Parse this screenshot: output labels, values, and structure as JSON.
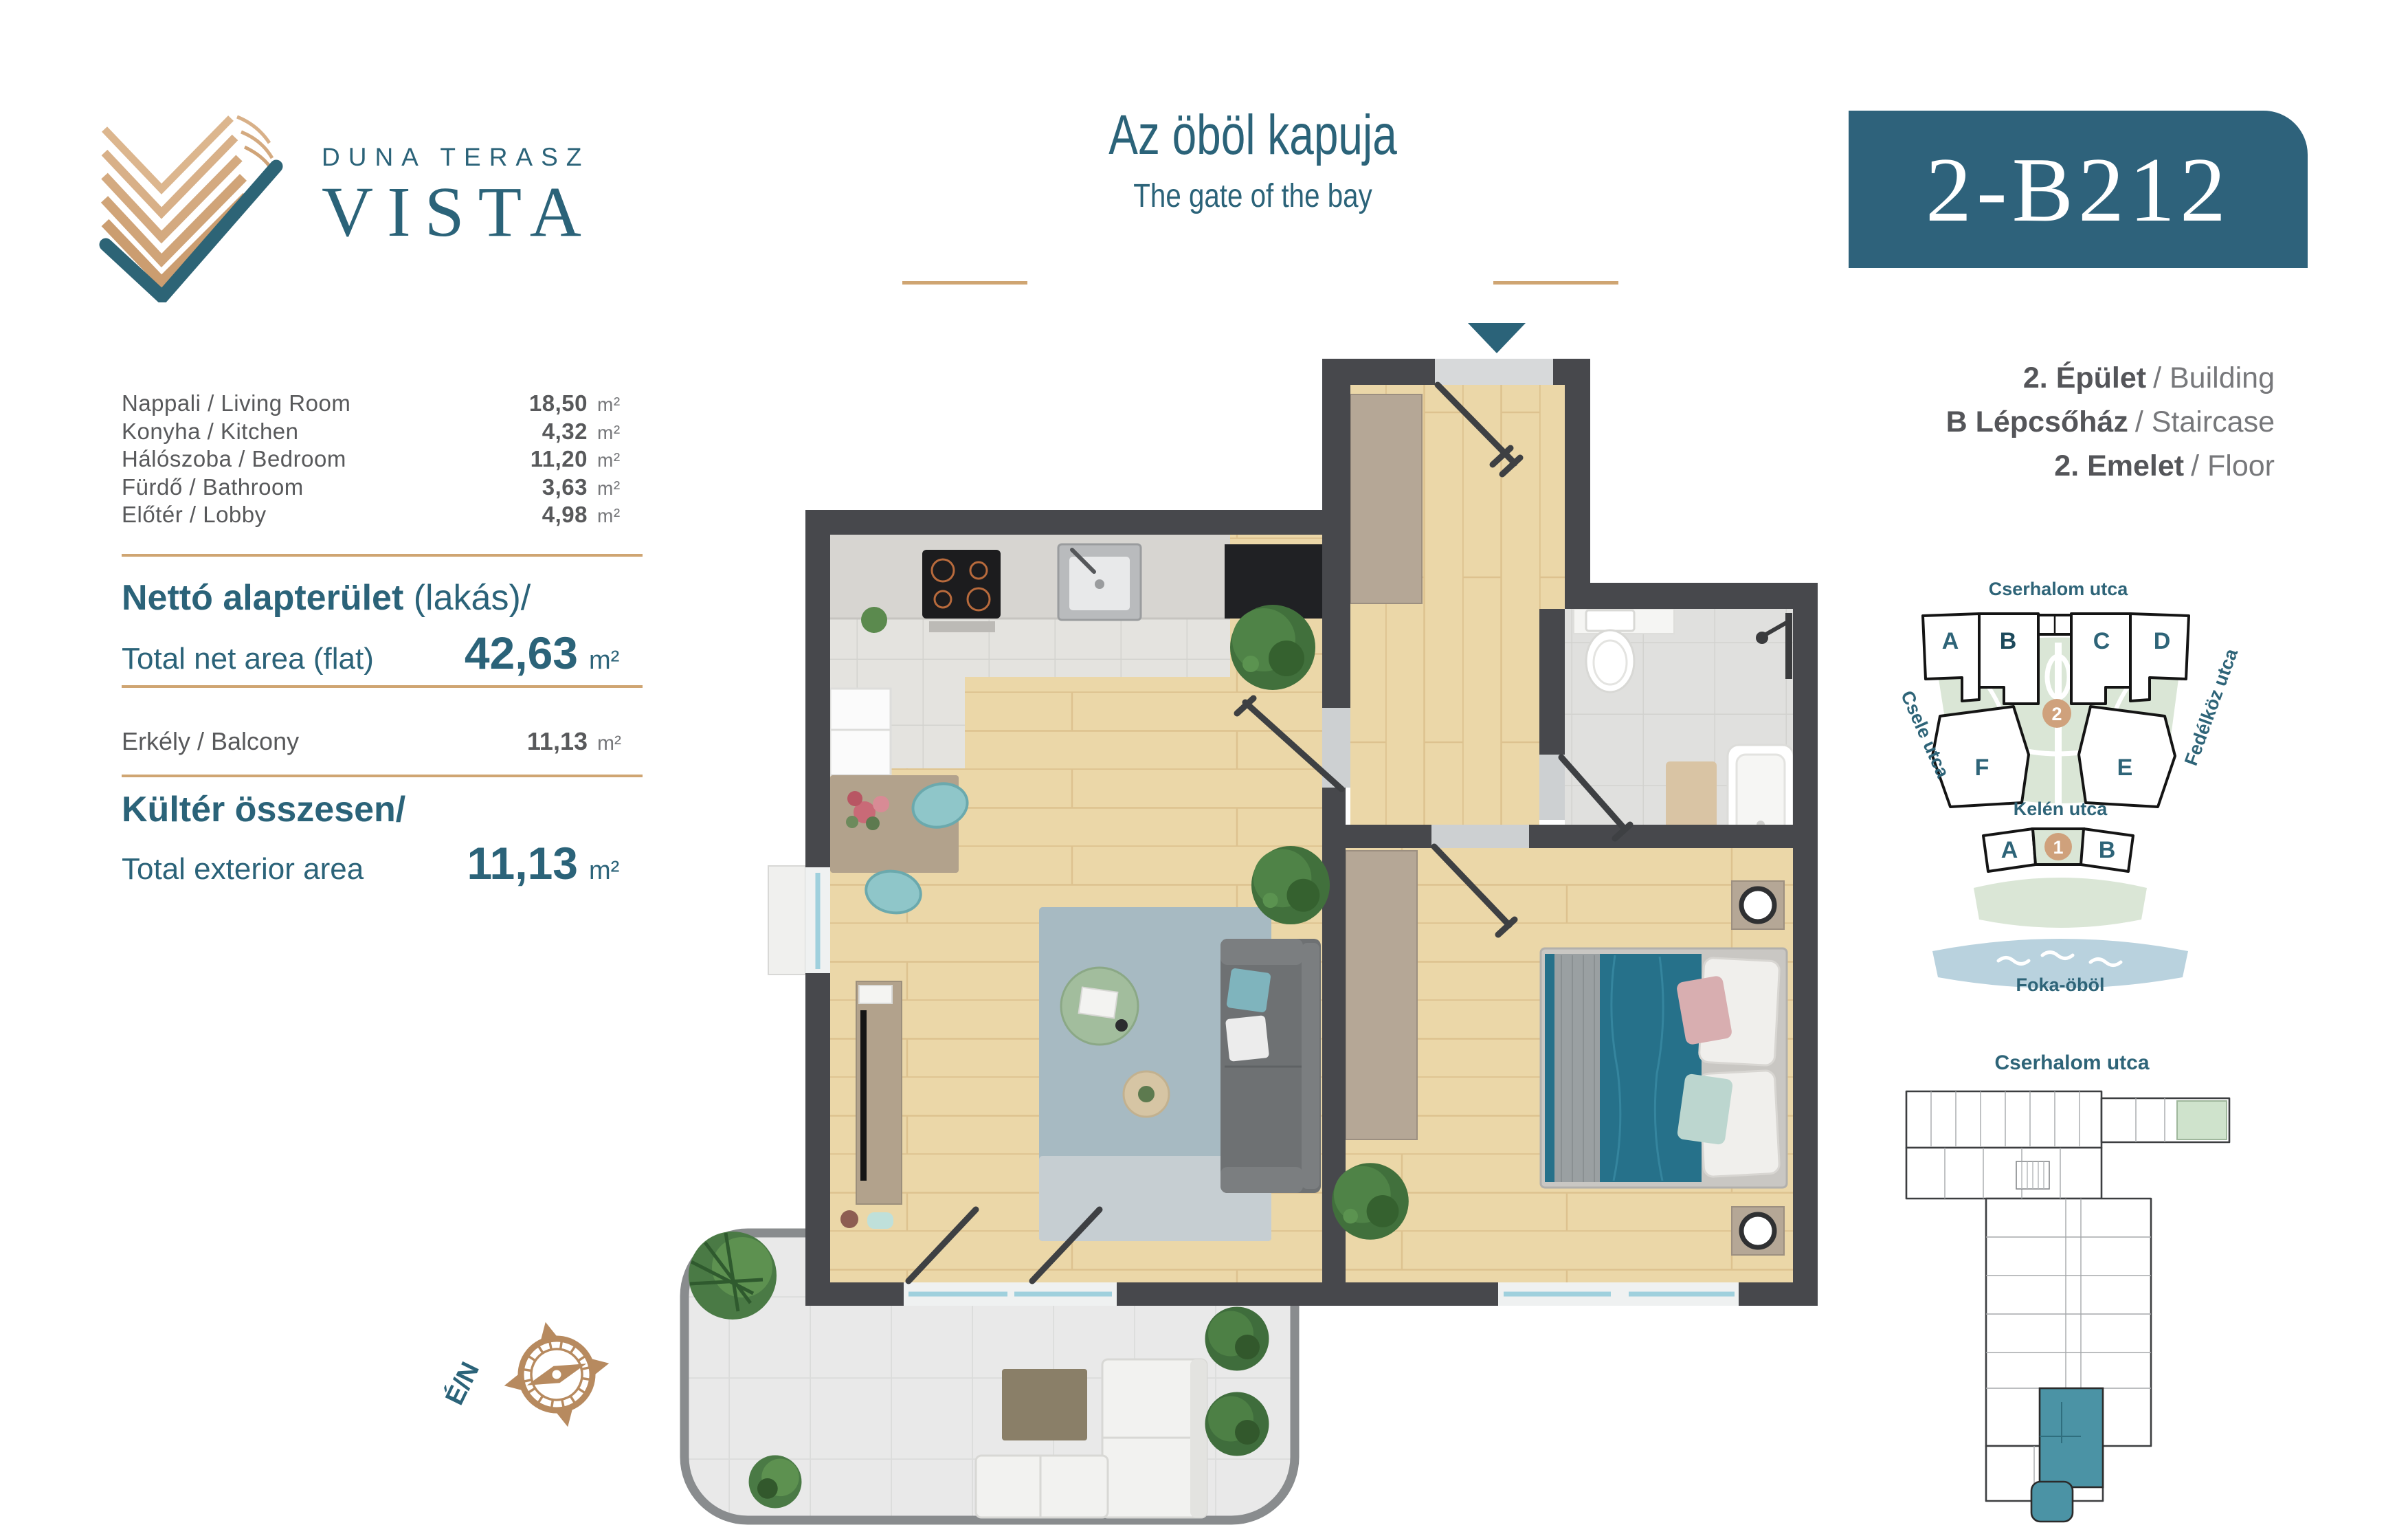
{
  "logo": {
    "tagline": "DUNA TERASZ",
    "name": "VISTA"
  },
  "header": {
    "title_hu": "Az öböl kapuja",
    "title_en": "The gate of the bay",
    "unit_code": "2-B212"
  },
  "areas": {
    "rooms": [
      {
        "label": "Nappali / Living Room",
        "value": "18,50",
        "unit": "m²"
      },
      {
        "label": "Konyha / Kitchen",
        "value": "4,32",
        "unit": "m²"
      },
      {
        "label": "Hálószoba / Bedroom",
        "value": "11,20",
        "unit": "m²"
      },
      {
        "label": "Fürdő / Bathroom",
        "value": "3,63",
        "unit": "m²"
      },
      {
        "label": "Előtér / Lobby",
        "value": "4,98",
        "unit": "m²"
      }
    ],
    "net": {
      "title_bold": "Nettó alapterület",
      "title_light": " (lakás)/",
      "label_en": "Total net area (flat)",
      "value": "42,63",
      "unit": "m²"
    },
    "balcony": {
      "label": "Erkély / Balcony",
      "value": "11,13",
      "unit": "m²"
    },
    "exterior": {
      "title": "Kültér összesen/",
      "label_en": "Total exterior area",
      "value": "11,13",
      "unit": "m²"
    }
  },
  "building_info": {
    "lines": [
      {
        "hu": "2. Épület",
        "en": "/ Building"
      },
      {
        "hu": "B Lépcsőház",
        "en": "/ Staircase"
      },
      {
        "hu": "2. Emelet",
        "en": "/ Floor"
      }
    ]
  },
  "site_map": {
    "street_top": "Cserhalom utca",
    "street_left": "Csele utca",
    "street_right": "Fedélköz utca",
    "street_mid": "Kelén utca",
    "water_label": "Foka-öböl",
    "building_a": "A",
    "building_b": "B",
    "building_c": "C",
    "building_d": "D",
    "building_f": "F",
    "building_e": "E",
    "phase_2": "2",
    "phase_1": "1",
    "lower_a": "A",
    "lower_b": "B",
    "highlighted_building": "B"
  },
  "mini_plan": {
    "street": "Cserhalom utca"
  },
  "compass": {
    "label": "É/N"
  },
  "colors": {
    "teal": "#2b6379",
    "badge": "#2e627b",
    "tan": "#cfa572",
    "tan-dark": "#b78a5f",
    "text-gray": "#58595b",
    "text-light": "#76777a",
    "wall": "#47484c",
    "wood": "#ebd7a8",
    "wood-line": "#ddc28f",
    "tile": "#e4e3df",
    "tile-line": "#d3d3cf",
    "bath": "#e0e0de",
    "bath-line": "#d2d2cf",
    "balcony": "#e9e9e9",
    "balcony-line": "#dbdcdb",
    "cabinet": "#b5a796",
    "rug": "#a7bac2",
    "rug-light": "#c6ced2",
    "sofa": "#6e7173",
    "bed": "#26718a",
    "site-green": "#dae6d6",
    "water": "#b9d2de",
    "marker": "#cfa17c",
    "map-teal": "#3f7f93",
    "mini-teal": "#4b93a5"
  }
}
